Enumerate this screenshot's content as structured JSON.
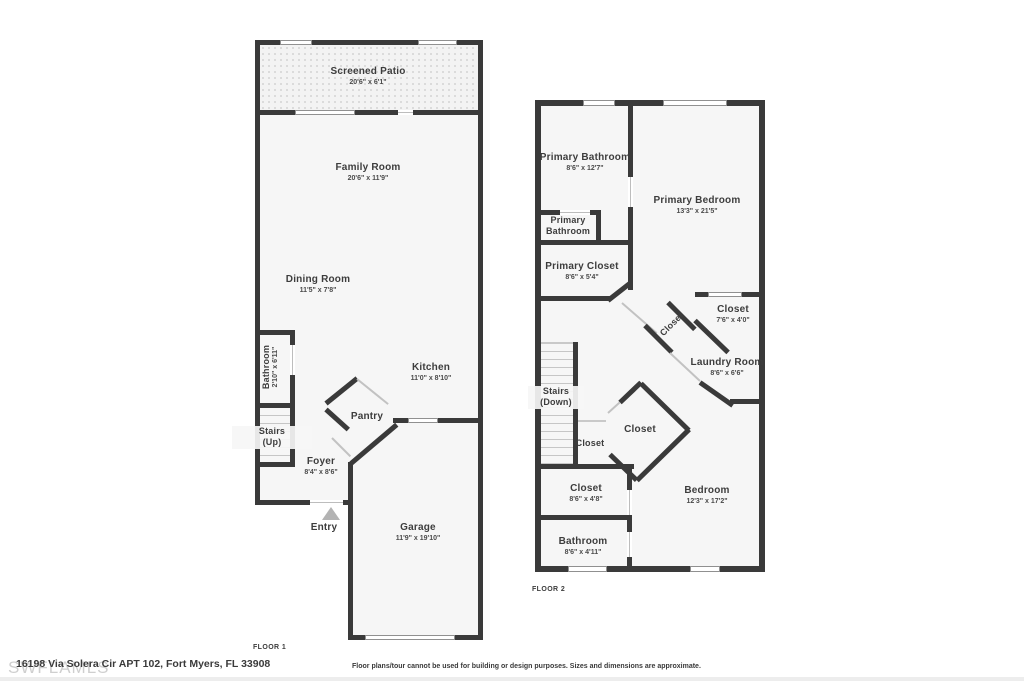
{
  "page": {
    "watermark": "SWFLAMLS",
    "address": "16198 Via Solera Cir APT 102, Fort Myers, FL 33908",
    "disclaimer": "Floor plans/tour cannot be used for building or design purposes. Sizes and dimensions are approximate."
  },
  "colors": {
    "wall": "#3a3a3a",
    "room_fill": "#f6f6f6",
    "door_line": "#c2c2c2"
  },
  "floor1": {
    "label": "FLOOR 1",
    "rooms": {
      "patio": {
        "name": "Screened Patio",
        "dims": "20'6\" x 6'1\""
      },
      "family": {
        "name": "Family Room",
        "dims": "20'6\" x 11'9\""
      },
      "dining": {
        "name": "Dining Room",
        "dims": "11'5\" x 7'8\""
      },
      "bathroom": {
        "name": "Bathroom",
        "dims": "2'10\" x 6'11\""
      },
      "stairs": {
        "line1": "Stairs",
        "line2": "(Up)"
      },
      "foyer": {
        "name": "Foyer",
        "dims": "8'4\" x 8'6\""
      },
      "pantry": {
        "name": "Pantry"
      },
      "kitchen": {
        "name": "Kitchen",
        "dims": "11'0\" x 8'10\""
      },
      "entry": {
        "name": "Entry"
      },
      "garage": {
        "name": "Garage",
        "dims": "11'9\" x 19'10\""
      }
    }
  },
  "floor2": {
    "label": "FLOOR 2",
    "rooms": {
      "primary_bathroom": {
        "name": "Primary Bathroom",
        "dims": "8'6\" x 12'7\""
      },
      "primary_bathroom_small": {
        "line1": "Primary",
        "line2": "Bathroom"
      },
      "primary_bedroom": {
        "name": "Primary Bedroom",
        "dims": "13'3\" x 21'5\""
      },
      "primary_closet": {
        "name": "Primary Closet",
        "dims": "8'6\" x 5'4\""
      },
      "closet_hall": {
        "name": "Closet"
      },
      "closet_right": {
        "name": "Closet",
        "dims": "7'6\" x 4'0\""
      },
      "laundry": {
        "name": "Laundry Room",
        "dims": "8'6\" x 6'6\""
      },
      "stairs": {
        "line1": "Stairs",
        "line2": "(Down)"
      },
      "closet_left": {
        "name": "Closet"
      },
      "closet_center": {
        "name": "Closet"
      },
      "closet_bottom": {
        "name": "Closet",
        "dims": "8'6\" x 4'8\""
      },
      "bedroom": {
        "name": "Bedroom",
        "dims": "12'3\" x 17'2\""
      },
      "bathroom": {
        "name": "Bathroom",
        "dims": "8'6\" x 4'11\""
      }
    }
  }
}
